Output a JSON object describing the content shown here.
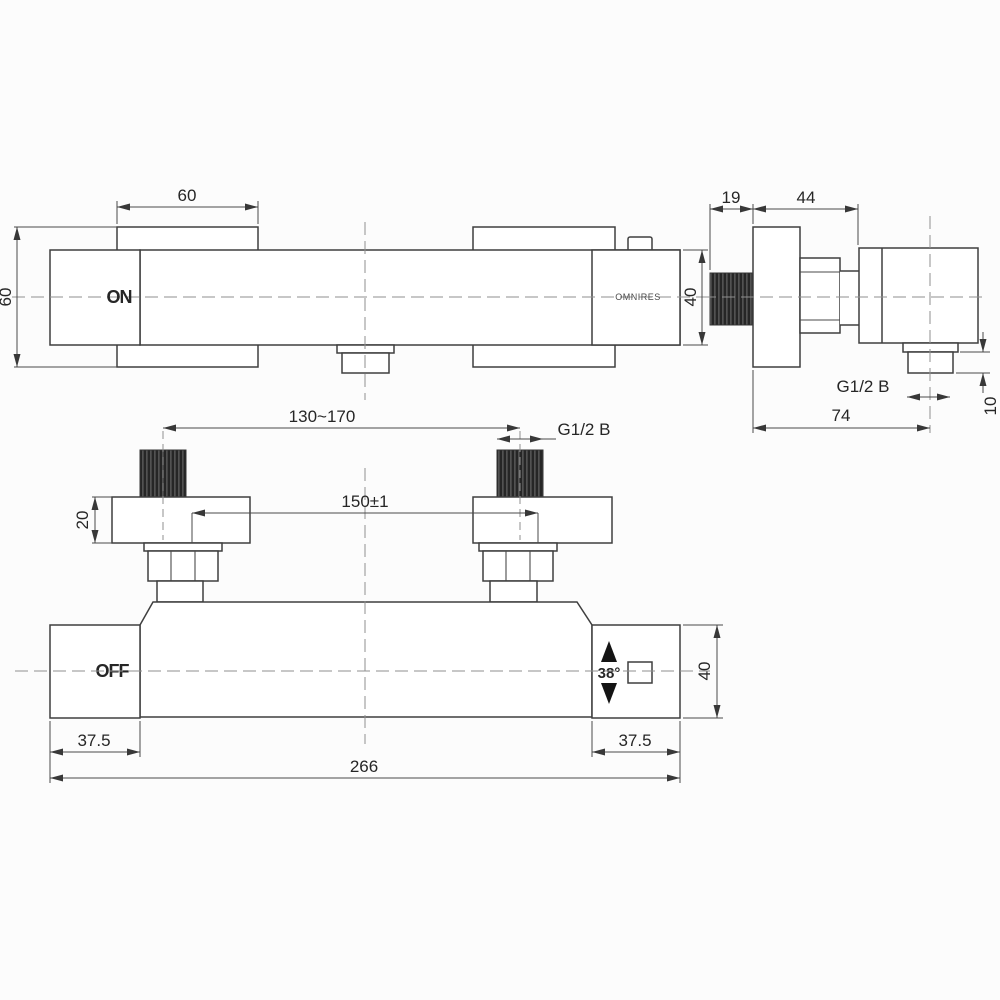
{
  "title": "Thermostatic shower mixer technical drawing",
  "brand": "OMNIRES",
  "front_view": {
    "handle_state": "ON",
    "dims": {
      "plate_width": "60",
      "plate_height": "60",
      "body_height": "40"
    }
  },
  "side_view": {
    "outlet_thread": "G1/2 B",
    "dims": {
      "thread_length": "19",
      "body_depth": "44",
      "total_depth": "74",
      "outlet_height": "10"
    }
  },
  "bottom_view": {
    "handle_state": "OFF",
    "temperature_stop": "38°",
    "inlet_thread": "G1/2 B",
    "dims": {
      "inlet_spacing_range": "130~170",
      "inlet_spacing": "150±1",
      "plate_thickness": "20",
      "handle_left_width": "37.5",
      "handle_right_width": "37.5",
      "handle_height": "40",
      "total_width": "266"
    }
  }
}
